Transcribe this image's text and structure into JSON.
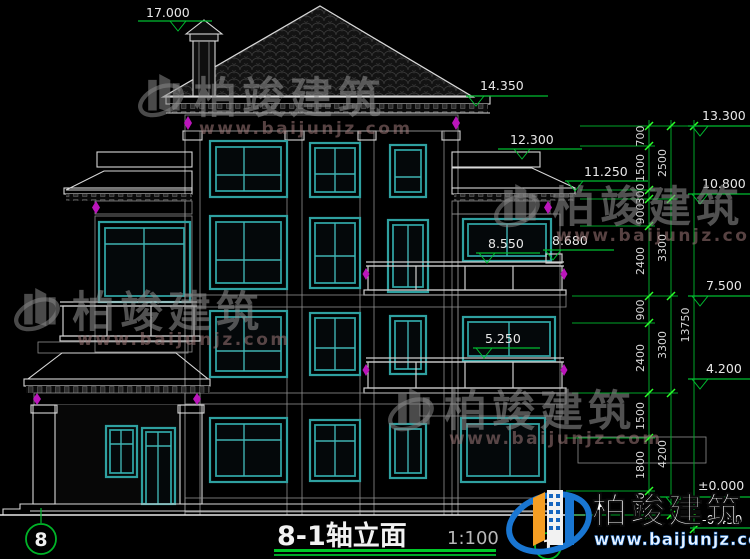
{
  "title": {
    "text": "8-1轴立面",
    "scale": "1:100"
  },
  "axis_bubbles": {
    "left": "8",
    "right": "1"
  },
  "elevation_markers": {
    "roof_top": "17.000",
    "main_eave": "14.350",
    "col_top": "13.300",
    "wing_parapet": "12.300",
    "wing_eave": "11.250",
    "col_2": "10.800",
    "balcony3_left": "8.550",
    "balcony3_right": "8.680",
    "col_3": "7.500",
    "balcony2": "5.250",
    "col_4": "4.200",
    "ground": "±0.000",
    "below_ground": "-0.450"
  },
  "dims": {
    "inner": [
      "700",
      "1500",
      "300",
      "900",
      "2400",
      "900",
      "2400",
      "1500",
      "1800",
      "900"
    ],
    "middle": [
      "2500",
      "3300",
      "3300",
      "4200"
    ],
    "total": "13750"
  },
  "watermark": {
    "brand": "柏竣建筑",
    "url": "www.baijunjz.com"
  },
  "logo": {
    "brand": "柏竣建筑",
    "url": "www.baijunjz.com"
  },
  "colors": {
    "background": "#000000",
    "line": "#d8d8d8",
    "window_teal": "#2fa0a0",
    "dimension_green": "#00a428",
    "tick_green": "#2bff2b",
    "accent_magenta": "#bb15bb",
    "logo_blue": "#1976d2",
    "logo_orange": "#f59e23"
  }
}
